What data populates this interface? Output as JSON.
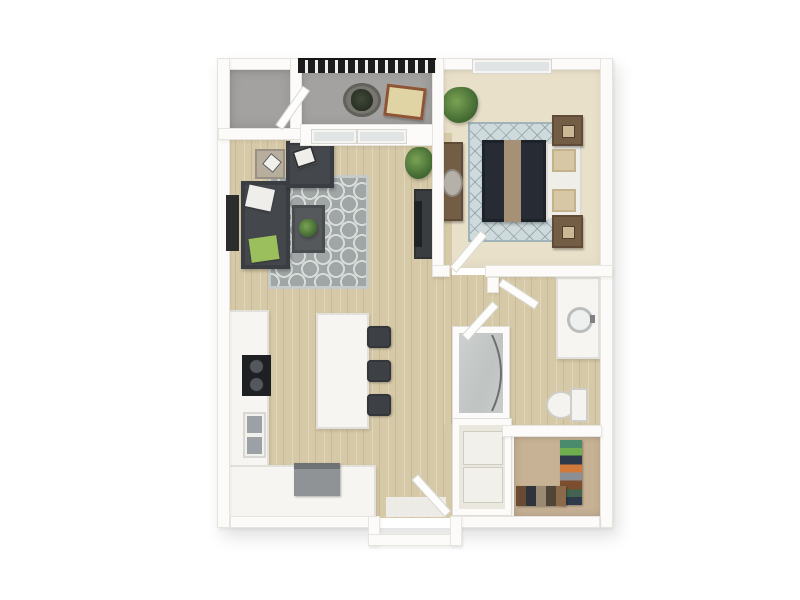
{
  "meta": {
    "title": "3D one-bedroom apartment floor plan",
    "view": "top-down 3D render",
    "visible_text": ""
  },
  "palette": {
    "background": "#ffffff",
    "wall": "#fcfbf9",
    "wall_edge": "#e6e4df",
    "wood_floor": "#d6c9a7",
    "balcony_floor": "#a3a2a0",
    "bedroom_carpet": "#e9e0c9",
    "closet_carpet": "#c8b295",
    "living_rug": "#a0a6a5",
    "bedroom_rug": "#cfdadc",
    "sofa_charcoal": "#44474b",
    "bed_duvet_navy": "#272b34",
    "bed_runner_tan": "#a79176",
    "wood_furniture_brown": "#745d45",
    "counter_white": "#f6f5f1",
    "stove_black": "#1f2023",
    "sink_gray": "#9ba1a4",
    "pillow_green": "#9cbf5e",
    "plant_green": "#4e7a3a",
    "railing_black": "#1d1d1d",
    "lounger_tan": "#e0d4a4",
    "lounger_frame": "#8e5438"
  },
  "rooms": {
    "balcony": {
      "label": "balcony"
    },
    "storage": {
      "label": "storage room"
    },
    "bedroom": {
      "label": "bedroom"
    },
    "living_room": {
      "label": "living room"
    },
    "kitchen": {
      "label": "kitchen"
    },
    "bathroom": {
      "label": "bathroom"
    },
    "laundry_closet": {
      "label": "laundry closet"
    },
    "walk_in_closet": {
      "label": "walk-in closet"
    },
    "entry": {
      "label": "entry"
    }
  },
  "furniture": {
    "sofa": "sectional sofa",
    "armchair": "armchair",
    "coffee_table": "coffee table",
    "tv": "wall tv",
    "media_console": "media console",
    "island": "kitchen island",
    "stools": "3 bar stools",
    "stove": "cooktop",
    "sink": "double sink",
    "bed": "queen bed",
    "nightstands": "2 nightstands",
    "dresser": "dresser with mirror",
    "vanity": "bathroom vanity",
    "toilet": "toilet",
    "shower": "glass shower",
    "washer_dryer": "shelved laundry closet",
    "balcony_set": "planter and lounge mat",
    "front_door": "entry door"
  }
}
